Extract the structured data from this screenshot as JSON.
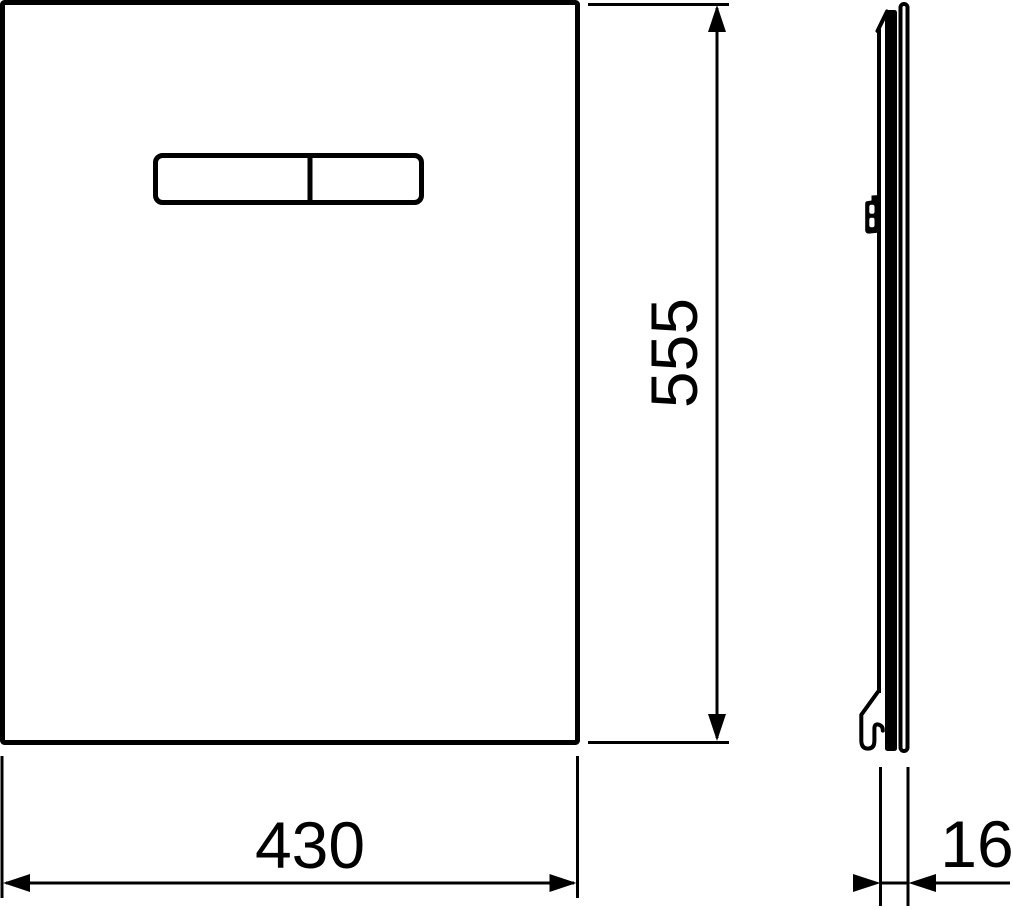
{
  "drawing": {
    "background_color": "#ffffff",
    "line_color": "#000000",
    "dimensions": {
      "height_label": "555",
      "width_label": "430",
      "depth_label": "16"
    }
  }
}
